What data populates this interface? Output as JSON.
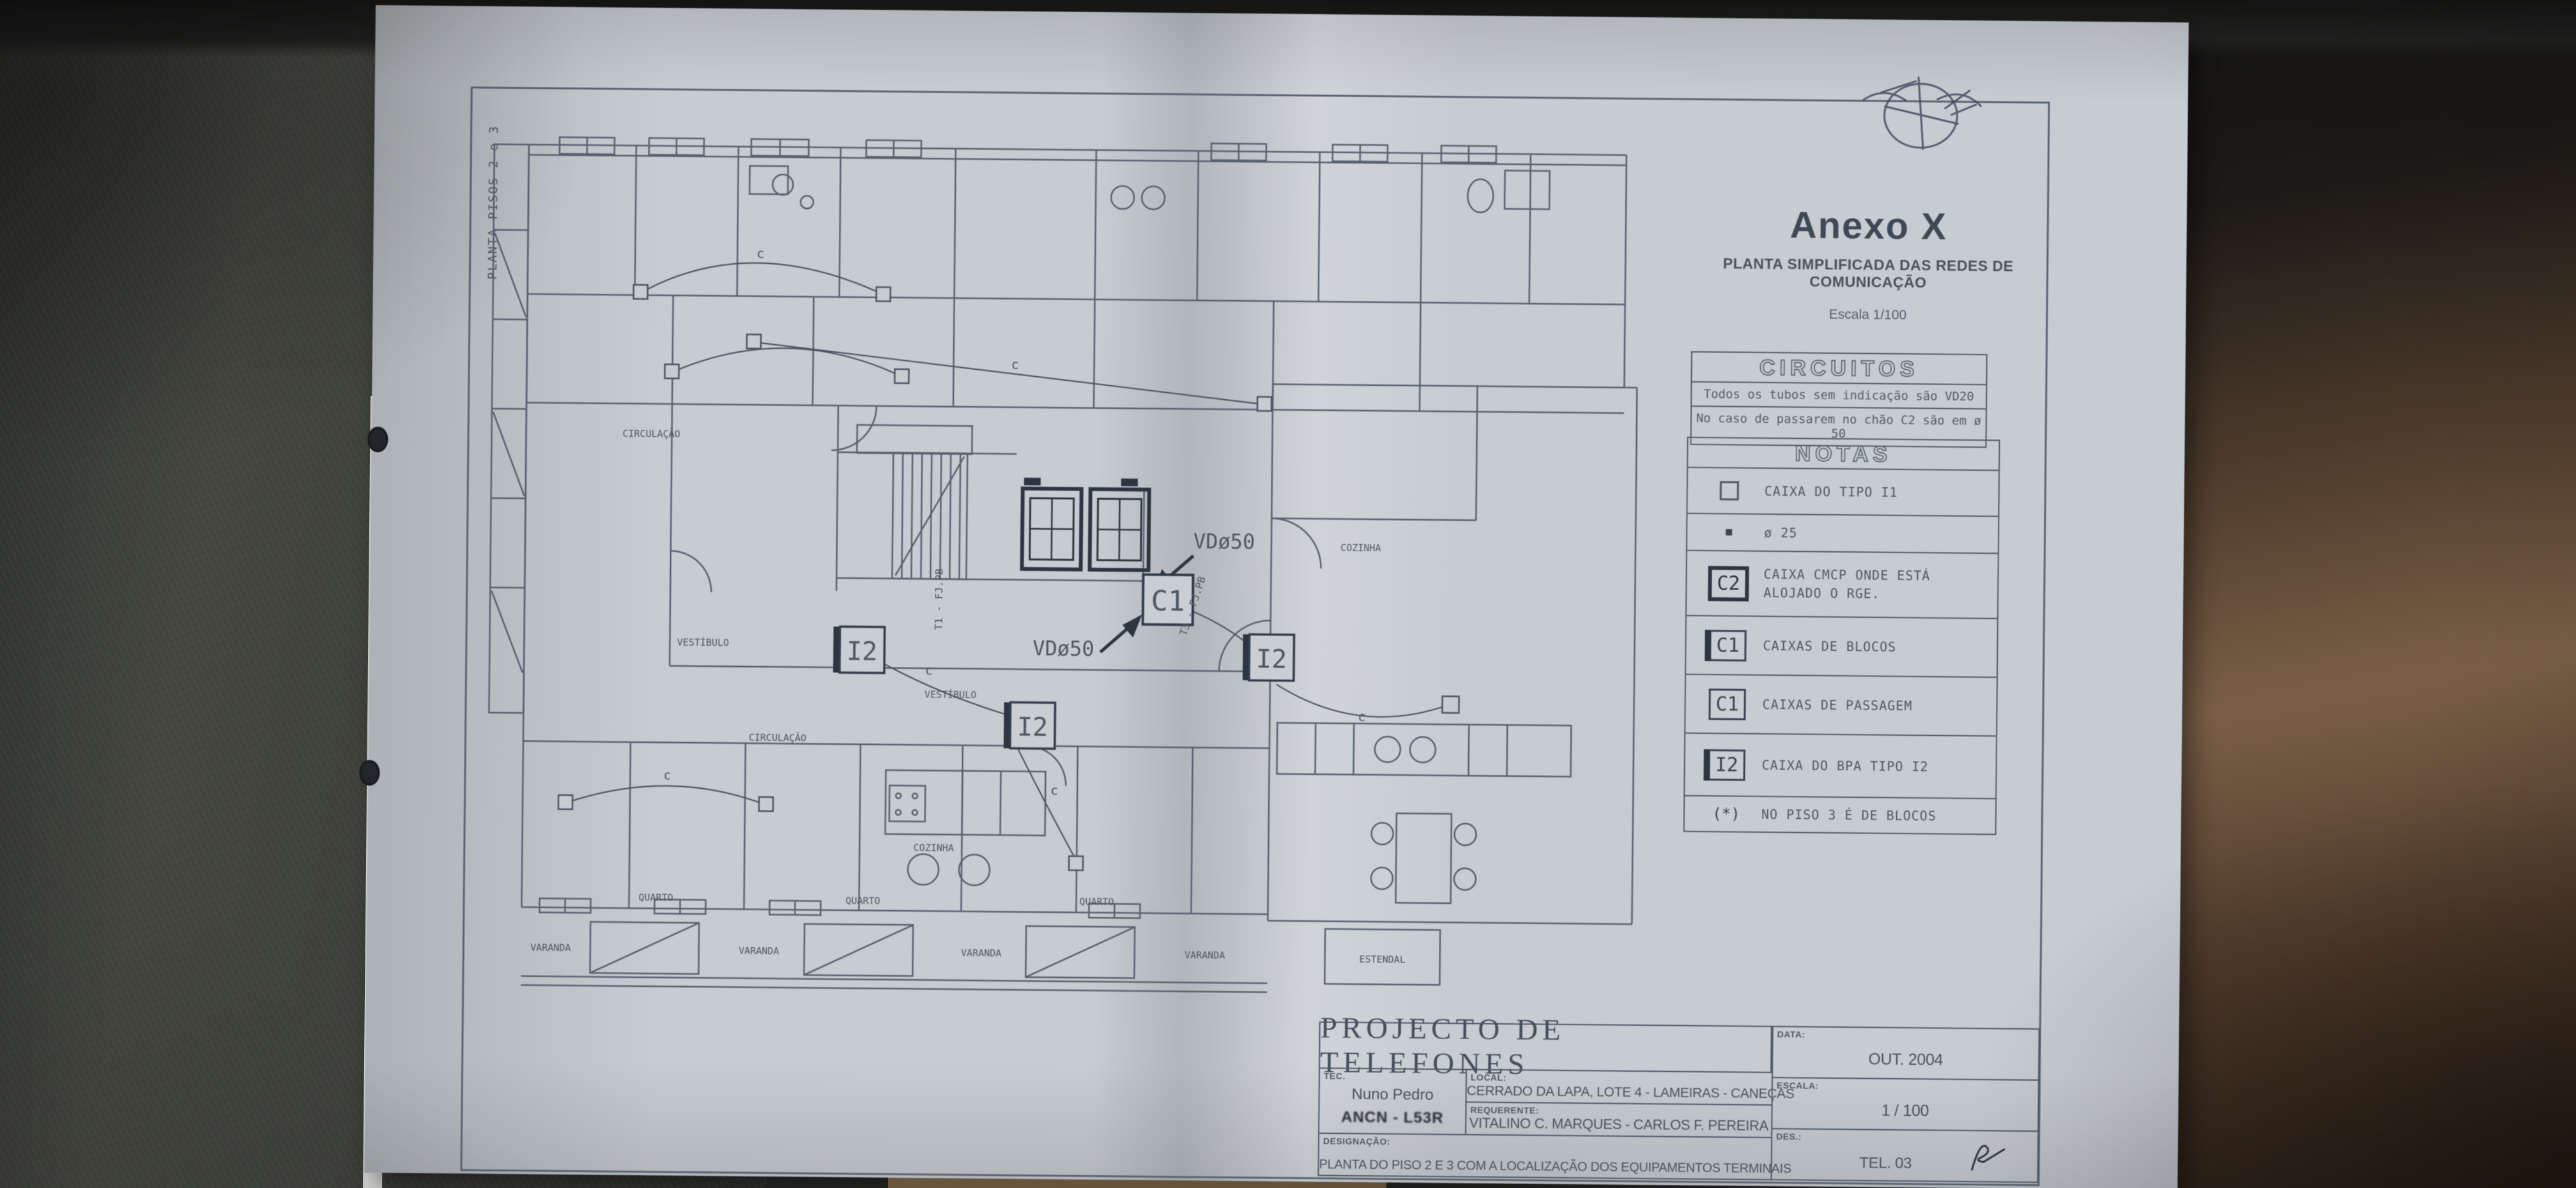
{
  "photo": {
    "paper_color": "#c7ccd2",
    "line_color": "#57616e",
    "ink_dark": "#2c3540",
    "leather_left": "#3d403c",
    "leather_right": "#5d4433"
  },
  "side_label": "PLANTA PISOS 2 e 3",
  "header": {
    "title": "Anexo X",
    "subtitle": "PLANTA SIMPLIFICADA DAS REDES DE COMUNICAÇÃO",
    "scale_note": "Escala 1/100"
  },
  "circuitos": {
    "title": "CIRCUITOS",
    "notes": [
      "Todos os tubos sem indicação são VD20",
      "No caso de passarem no chão C2 são em ø 50"
    ]
  },
  "notas": {
    "title": "NOTAS",
    "items": [
      {
        "badge": "",
        "label": "CAIXA DO TIPO I1"
      },
      {
        "badge": "",
        "label": "ø 25"
      },
      {
        "badge": "C2",
        "label": "CAIXA CMCP ONDE ESTÁ ALOJADO O RGE."
      },
      {
        "badge": "C1",
        "label": "CAIXAS DE BLOCOS"
      },
      {
        "badge": "C1",
        "label": "CAIXAS DE PASSAGEM"
      },
      {
        "badge": "I2",
        "label": "CAIXA DO BPA TIPO I2"
      },
      {
        "badge": "(*)",
        "label": "NO PISO 3 É DE BLOCOS"
      }
    ]
  },
  "plan": {
    "rooms": {
      "quarto": "QUARTO",
      "varanda": "VARANDA",
      "estendal": "ESTENDAL",
      "cozinha": "COZINHA",
      "circulacao": "CIRCULAÇÃO",
      "vestibulo": "VESTÍBULO"
    },
    "boxes": {
      "c1": "C1",
      "i2": "I2"
    },
    "ducts": {
      "vd50": "VDø50",
      "t1": "T1 - FJ.PB",
      "t3": "T3 - FJ.PB"
    },
    "cable_mark": "c"
  },
  "title_block": {
    "title": "PROJECTO DE TELEFONES",
    "tec_label": "TEC.",
    "tec_name": "Nuno Pedro",
    "tec_stamp": "ANCN - L53R",
    "local_label": "LOCAL:",
    "local_value": "CERRADO DA LAPA, LOTE 4 - LAMEIRAS - CANEÇAS",
    "requerente_label": "REQUERENTE:",
    "requerente_value": "VITALINO C. MARQUES - CARLOS F. PEREIRA",
    "designacao_label": "DESIGNAÇÃO:",
    "designacao_value": "PLANTA DO PISO 2 E 3 COM A LOCALIZAÇÃO DOS EQUIPAMENTOS TERMINAIS",
    "data_label": "DATA:",
    "data_value": "OUT. 2004",
    "escala_label": "ESCALA:",
    "escala_value": "1 / 100",
    "des_label": "DES.:",
    "des_value": "TEL. 03"
  }
}
